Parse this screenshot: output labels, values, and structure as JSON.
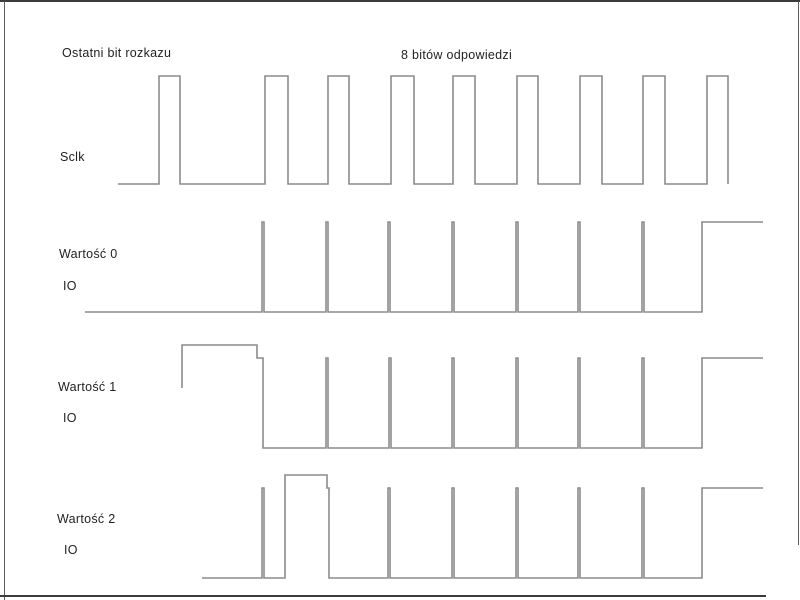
{
  "annotations": {
    "last_command_bit": "Ostatni bit rozkazu",
    "response_bits": "8 bitów odpowiedzi"
  },
  "rows": {
    "sclk": {
      "label": "Sclk"
    },
    "value0": {
      "label": "Wartość 0",
      "io_label": "IO"
    },
    "value1": {
      "label": "Wartość 1",
      "io_label": "IO"
    },
    "value2": {
      "label": "Wartość 2",
      "io_label": "IO"
    }
  },
  "colors": {
    "waveform_line": "#8c8c8c",
    "border_dark": "#3c3c3c",
    "border_light": "#5f5f5f",
    "text": "#1f1f1f",
    "background": "#ffffff"
  },
  "signals": {
    "sclk": {
      "name": "Sclk",
      "num_pulses": 9,
      "high_y": 76,
      "low_y": 184,
      "pulse_x_ranges": [
        [
          159,
          180
        ],
        [
          265,
          288
        ],
        [
          328,
          349
        ],
        [
          391,
          414
        ],
        [
          453,
          475
        ],
        [
          517,
          538
        ],
        [
          580,
          602
        ],
        [
          643,
          665
        ],
        [
          707,
          728
        ]
      ],
      "points": "118,184 159,184 159,76 180,76 180,184 265,184 265,76 288,76 288,184 328,184 328,76 349,76 349,184 391,184 391,76 414,76 414,184 453,184 453,76 475,76 475,184 517,184 517,76 538,76 538,184 580,184 580,76 602,76 602,184 643,184 643,76 665,76 665,184 707,184 707,76 728,76 728,184"
    },
    "value0": {
      "name": "Wartość 0 IO",
      "high_y": 222,
      "low_y": 312,
      "spike_x": [
        263,
        327,
        389,
        453,
        517,
        579,
        643
      ],
      "final_high_x_range": [
        702,
        763
      ],
      "points": "85,312 262,312 262,222 264,222 264,312 326,312 326,222 328,222 328,312 388,312 388,222 390,222 390,312 452,312 452,222 454,222 454,312 516,312 516,222 518,222 518,312 578,312 578,222 580,222 580,312 642,312 642,222 644,222 644,312 702,312 702,222 763,222"
    },
    "value1": {
      "name": "Wartość 1 IO",
      "start_high_y": 345,
      "step_y": 358,
      "low_y": 448,
      "initial_high_x_range": [
        182,
        257
      ],
      "spike_x": [
        327,
        390,
        453,
        517,
        579,
        643
      ],
      "final_high_x_range": [
        702,
        763
      ],
      "points": "182,388 182,345 257,345 257,358 263,358 263,448 326,448 326,358 328,358 328,448 389,448 389,358 391,358 391,448 452,448 452,358 454,358 454,448 516,448 516,358 518,358 518,448 578,448 578,358 580,358 580,448 642,448 642,358 644,358 644,448 702,448 702,358 763,358"
    },
    "value2": {
      "name": "Wartość 2 IO",
      "start_high_y": 475,
      "step_y": 488,
      "low_y": 578,
      "initial_high_x_range": [
        285,
        327
      ],
      "spike_x": [
        263,
        389,
        453,
        517,
        579,
        643
      ],
      "final_high_x_range": [
        702,
        763
      ],
      "points": "202,578 262,578 262,488 264,488 264,578 285,578 285,475 327,475 327,488 329,488 329,578 388,578 388,488 390,488 390,578 452,578 452,488 454,488 454,578 516,578 516,488 518,488 518,578 578,578 578,488 580,488 580,578 642,578 642,488 644,488 644,578 702,578 702,488 763,488"
    }
  }
}
